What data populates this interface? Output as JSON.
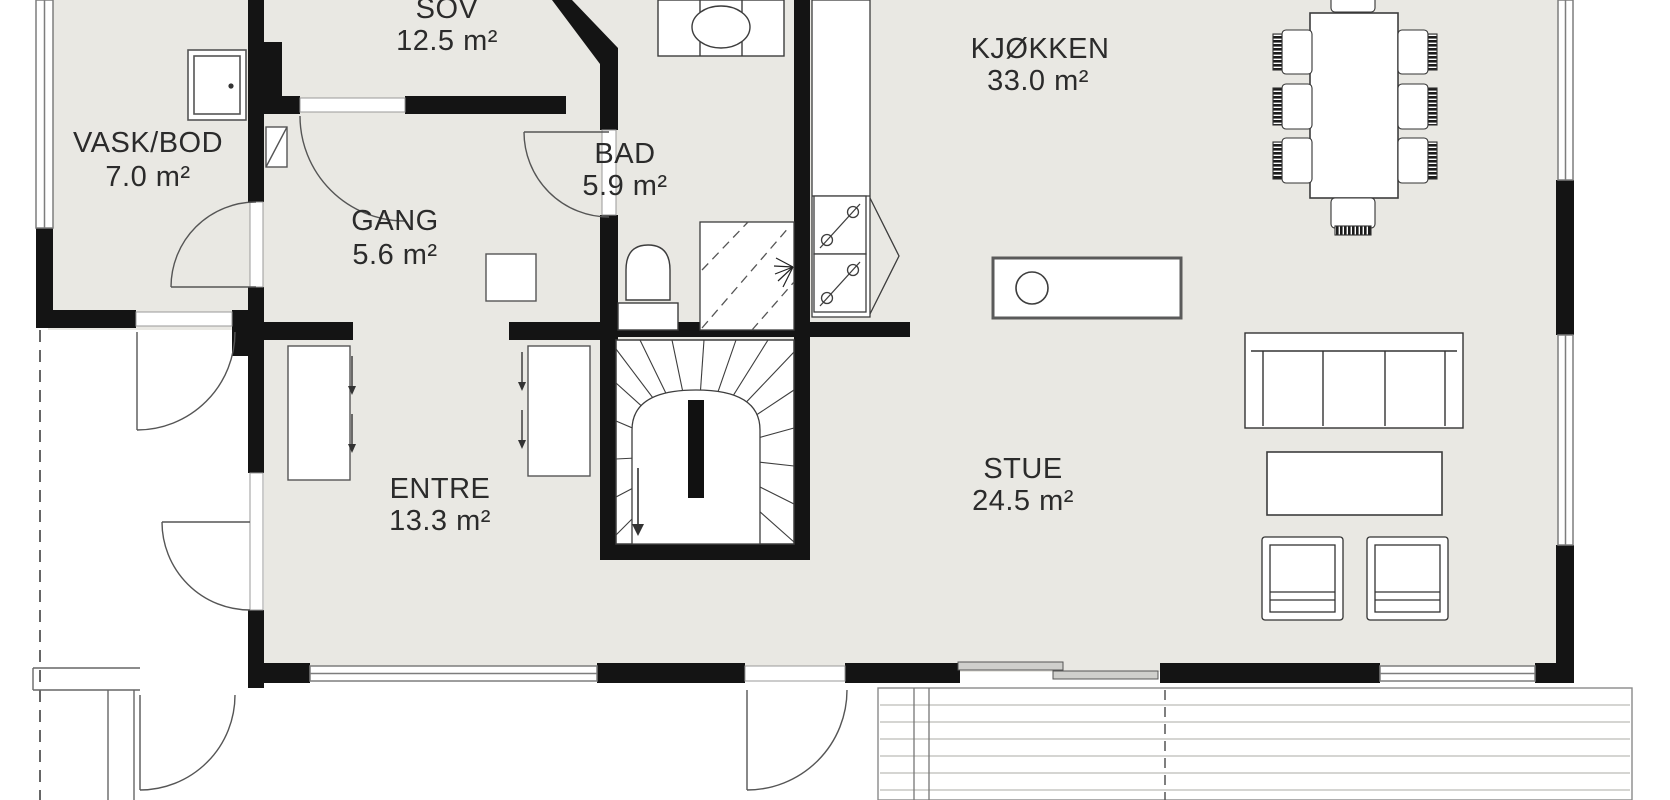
{
  "plan": {
    "title": "First floor plan",
    "rooms": [
      {
        "name": "SOV",
        "area": "12.5 m²"
      },
      {
        "name": "VASK/BOD",
        "area": "7.0 m²"
      },
      {
        "name": "GANG",
        "area": "5.6 m²"
      },
      {
        "name": "BAD",
        "area": "5.9 m²"
      },
      {
        "name": "KJØKKEN",
        "area": "33.0 m²"
      },
      {
        "name": "ENTRE",
        "area": "13.3 m²"
      },
      {
        "name": "STUE",
        "area": "24.5 m²"
      }
    ],
    "fixtures": [
      "stairs-winder",
      "dining-table",
      "dining-chair",
      "kitchen-island",
      "round-sink",
      "cooktop-burners",
      "kitchen-counter",
      "sofa",
      "coffee-table",
      "armchair",
      "toilet",
      "vanity-basin",
      "shower-corner",
      "wardrobe",
      "appliance-cabinet",
      "vent-shaft",
      "sliding-door",
      "deck-planks",
      "door-swing",
      "roof-overhang-dashed"
    ],
    "colors": {
      "floor": "#e9e8e3",
      "wall": "#141414",
      "outline": "#3d3d3d",
      "window": "#7d7d7d",
      "deck_line": "#bcbcb7",
      "text": "#2b2b2b"
    }
  }
}
